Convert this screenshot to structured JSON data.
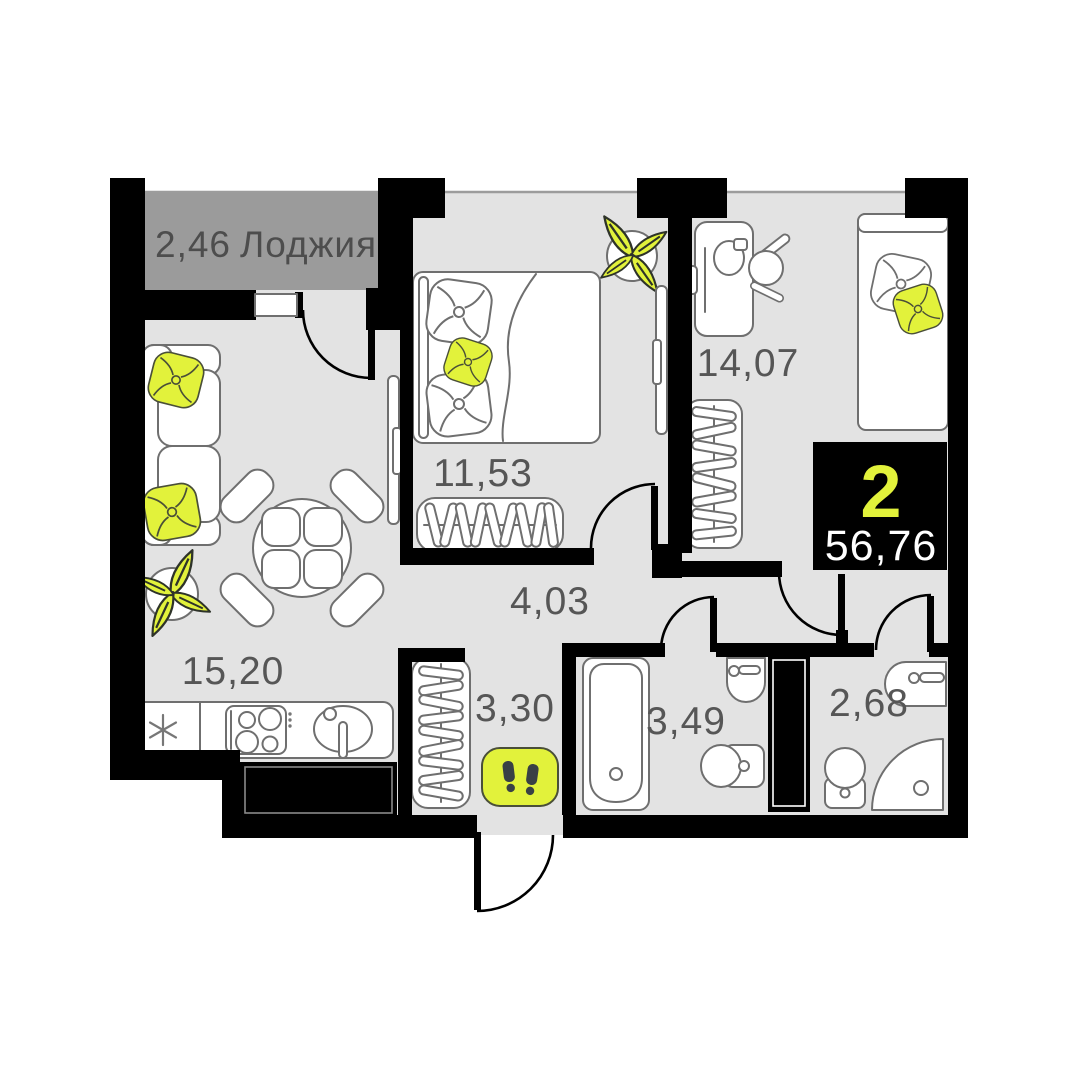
{
  "plan": {
    "type": "apartment-floor-plan",
    "badge": {
      "rooms_count": "2",
      "total_area": "56,76"
    },
    "rooms": {
      "loggia": {
        "area": "2,46",
        "name": "Лоджия"
      },
      "bedroom": {
        "area": "11,53"
      },
      "bedroom2": {
        "area": "14,07"
      },
      "living_kitchen": {
        "area": "15,20"
      },
      "corridor": {
        "area": "4,03"
      },
      "hallway": {
        "area": "3,30"
      },
      "bathroom": {
        "area": "3,49"
      },
      "wc": {
        "area": "2,68"
      }
    },
    "colors": {
      "wall": "#000000",
      "floor": "#e3e3e3",
      "loggia_floor": "#9b9b9b",
      "accent_yellow": "#e2f23b",
      "label_text": "#565656",
      "badge_bg": "#000000",
      "badge_rooms_color": "#e2f23b",
      "badge_area_color": "#ffffff"
    },
    "icons": {
      "entrance": "footprints-icon",
      "fridge": "snowflake-icon"
    }
  }
}
